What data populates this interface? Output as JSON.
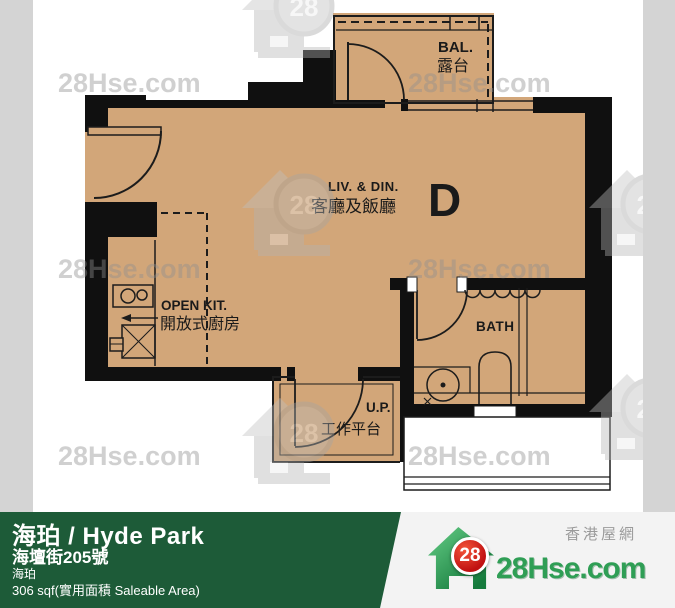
{
  "watermark": {
    "text": "28Hse.com",
    "badge": "28"
  },
  "plan": {
    "unit_label": "D",
    "balcony_en": "BAL.",
    "balcony_zh": "露台",
    "living_en": "LIV.  &  DIN.",
    "living_zh": "客廳及飯廳",
    "kitchen_en": "OPEN  KIT.",
    "kitchen_zh": "開放式廚房",
    "bath_en": "BATH",
    "up_en": "U.P.",
    "up_zh": "工作平台"
  },
  "footer": {
    "title": "海珀 / Hyde Park",
    "address": "海壇街205號",
    "estate": "海珀",
    "area": "306 sqf(實用面積 Saleable Area)",
    "logo_badge": "28",
    "logo_site": "28Hse.com",
    "logo_tagline": "香港屋網"
  },
  "colors": {
    "floor": "#d2a679",
    "wall": "#101010",
    "side_strip": "#d4d4d4",
    "footer_green": "#1d5b38",
    "logo_green": "#2f9e55",
    "badge_red": "#c01111",
    "watermark_gray": "#8e8e8e"
  }
}
